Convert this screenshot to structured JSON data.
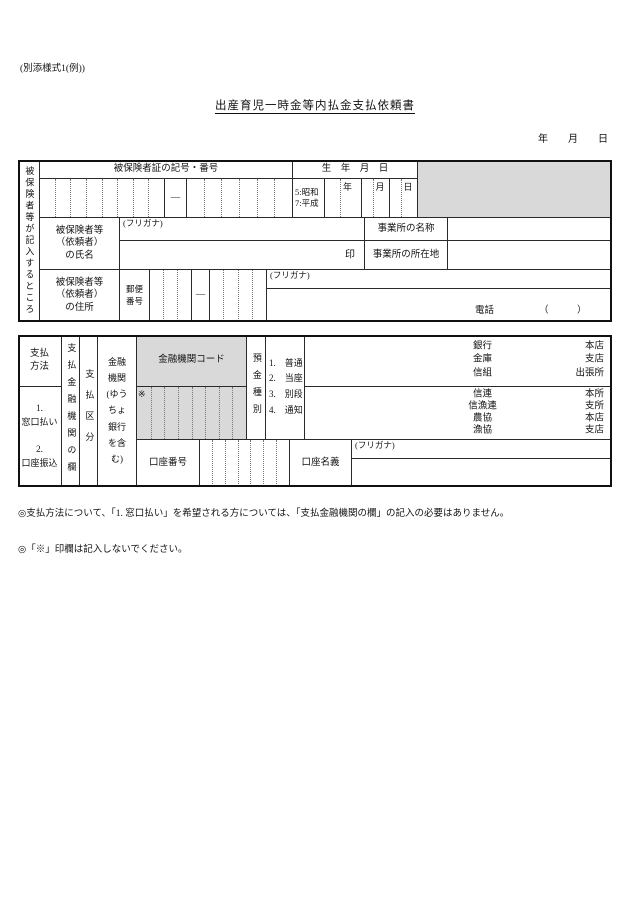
{
  "page": {
    "form_ref": "(別添様式1(例))",
    "title": "出産育児一時金等内払金支払依頼書",
    "date_line": "年　　月　　日"
  },
  "section1": {
    "side_label": "被保険者等が記入するところ",
    "cert_header": "被保険者証の記号・番号",
    "dash": "―",
    "birth": {
      "header": "生　年　月　日",
      "era": "5:昭和\n7:平成",
      "year": "年",
      "month": "月",
      "day": "日"
    },
    "name": {
      "label": "被保険者等\n（依頼者）\nの氏名",
      "furigana": "(フリガナ)",
      "seal": "印"
    },
    "office": {
      "name_label": "事業所の名称",
      "addr_label": "事業所の所在地"
    },
    "address": {
      "label": "被保険者等\n（依頼者）\nの住所",
      "postal_label": "郵便\n番号",
      "dash": "―",
      "furigana": "(フリガナ)",
      "tel_label": "電話",
      "tel_parens": "（　　　）"
    }
  },
  "section2": {
    "method_label": "支払\n方法",
    "method_options": "1.\n窓口払い\n\n2.\n口座振込",
    "pay_column_label": "支払金融機関の欄",
    "pay_category_label": "支払区分",
    "institution_label": "金融\n機関\n(ゆう\nちょ\n銀行\nを含\nむ)",
    "code_header": "金融機関コード",
    "star": "※",
    "deposit_label": "預金種別",
    "deposit_options": "1.　普通\n2.　当座\n3.　別段\n4.　通知",
    "bank_types_1": "銀行\n金庫\n信組",
    "bank_branches_1": "本店\n支店\n出張所",
    "bank_types_2": "信連\n信漁連\n農協\n漁協",
    "bank_branches_2": "本所\n支所\n本店\n支店",
    "account_number_label": "口座番号",
    "account_name_label": "口座名義",
    "account_furigana": "(フリガナ)"
  },
  "notes": {
    "note1": "◎支払方法について、「1. 窓口払い」を希望される方については、「支払金融機関の欄」の記入の必要はありません。",
    "note2": "◎「※」印欄は記入しないでください。"
  },
  "colors": {
    "shaded": "#d9d9d9",
    "line": "#2a2a2a"
  }
}
